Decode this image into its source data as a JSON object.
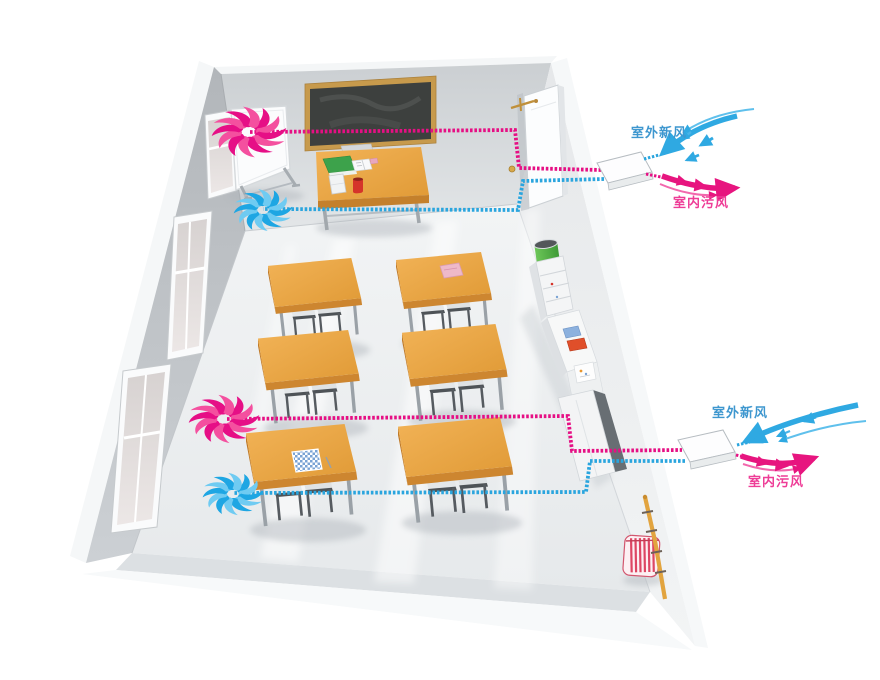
{
  "diagram": {
    "type": "illustration",
    "top_unit": {
      "fresh_air_label": "室外新风",
      "exhaust_air_label": "室内污风"
    },
    "bottom_unit": {
      "fresh_air_label": "室外新风",
      "exhaust_air_label": "室内污风"
    },
    "colors": {
      "fresh_air_blue": "#2fa9e2",
      "exhaust_air_magenta": "#e60f84",
      "fresh_air_label_text": "#3e97cf",
      "exhaust_air_label_text": "#ee3d97",
      "desk_wood": "#e9a945",
      "trash_can_green": "#53b848",
      "blackboard_frame": "#c79a4c",
      "heating_pipe": "#e2a43f"
    },
    "icons": {
      "exhaust_fan": "exhaust-fan-icon",
      "supply_fan": "supply-fan-icon",
      "fresh_air_arrows": "fresh-air-arrows",
      "exhaust_air_arrows": "exhaust-air-arrows"
    }
  }
}
